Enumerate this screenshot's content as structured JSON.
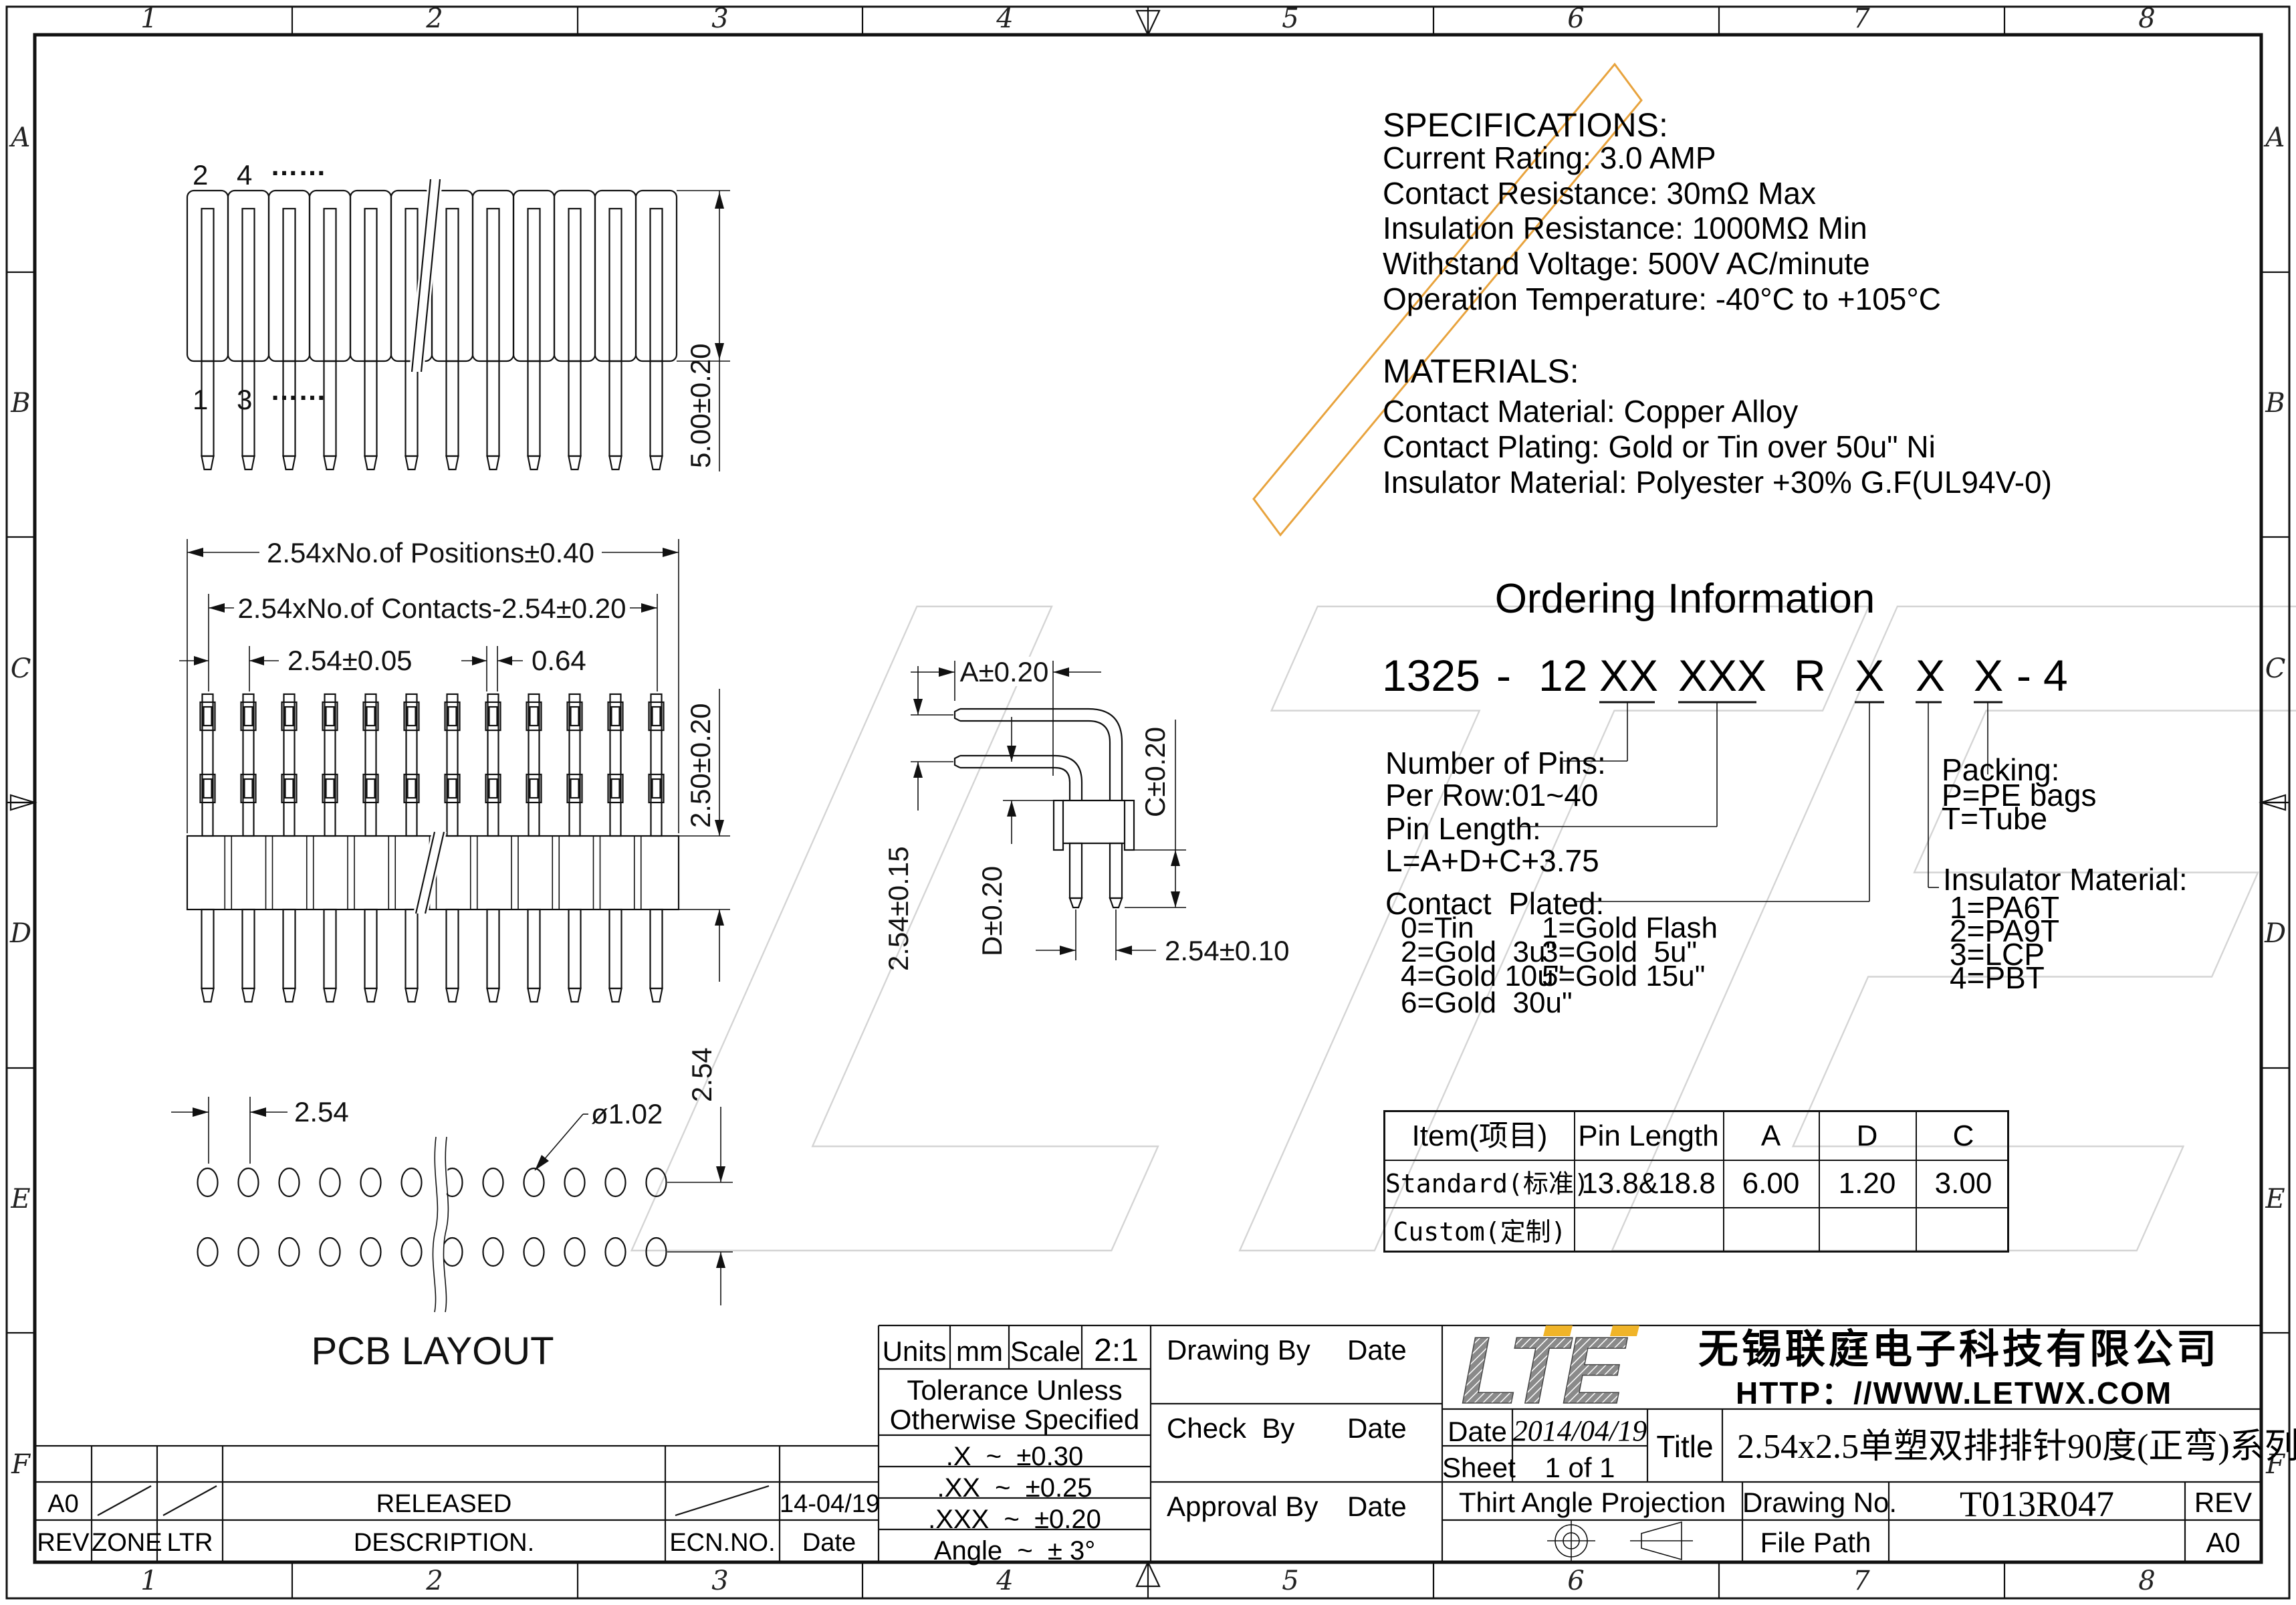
{
  "frame": {
    "zone_columns": [
      "1",
      "2",
      "3",
      "4",
      "5",
      "6",
      "7",
      "8"
    ],
    "zone_rows": [
      "A",
      "B",
      "C",
      "D",
      "E",
      "F"
    ]
  },
  "watermark": {
    "text": "LTE"
  },
  "specifications": {
    "heading": "SPECIFICATIONS:",
    "lines": [
      "Current Rating: 3.0 AMP",
      "Contact Resistance: 30mΩ Max",
      "Insulation Resistance: 1000MΩ Min",
      "Withstand Voltage: 500V AC/minute",
      "Operation Temperature: -40°C to +105°C"
    ]
  },
  "materials": {
    "heading": "MATERIALS:",
    "lines": [
      "Contact Material: Copper Alloy",
      "Contact Plating: Gold or Tin over 50u\" Ni",
      "Insulator Material: Polyester +30% G.F(UL94V-0)"
    ]
  },
  "ordering": {
    "title": "Ordering Information",
    "part_segments": [
      "1325",
      "-",
      "12",
      "XX",
      "XXX",
      "R",
      "X",
      "X",
      "X",
      "-",
      "4"
    ],
    "number_of_pins": [
      "Number of Pins:",
      "Per Row:01~40"
    ],
    "pin_length": [
      "Pin Length:",
      "L=A+D+C+3.75"
    ],
    "contact_plated_heading": "Contact  Plated:",
    "contact_plated": [
      "0=Tin",
      "1=Gold Flash",
      "2=Gold  3u\"",
      "3=Gold  5u\"",
      "4=Gold 10u\"",
      "5=Gold 15u\"",
      "6=Gold  30u\""
    ],
    "packing": [
      "Packing:",
      "P=PE bags",
      "T=Tube"
    ],
    "insulator": [
      "Insulator Material:",
      "1=PA6T",
      "2=PA9T",
      "3=LCP",
      "4=PBT"
    ]
  },
  "spec_table": {
    "headers": [
      "Item(项目)",
      "Pin Length",
      "A",
      "D",
      "C"
    ],
    "rows": [
      [
        "Standard(标准)",
        "13.8&18.8",
        "6.00",
        "1.20",
        "3.00"
      ],
      [
        "Custom(定制)",
        "",
        "",
        "",
        ""
      ]
    ]
  },
  "drawings": {
    "visible_pins": 12,
    "front_view": {
      "top_labels": [
        "2",
        "4",
        "……"
      ],
      "bottom_labels": [
        "1",
        "3",
        "……"
      ],
      "dim_height": "5.00±0.20"
    },
    "top_view": {
      "dim_positions": "2.54xNo.of Positions±0.40",
      "dim_contacts": "2.54xNo.of Contacts-2.54±0.20",
      "dim_pitch": "2.54±0.05",
      "dim_width": "0.64",
      "dim_housing": "2.50±0.20"
    },
    "side_view": {
      "dim_a": "A±0.20",
      "dim_row_pitch": "2.54±0.15",
      "dim_d": "D±0.20",
      "dim_c": "C±0.20",
      "dim_tail_pitch": "2.54±0.10"
    },
    "pcb_layout": {
      "title": "PCB LAYOUT",
      "dim_pitch": "2.54",
      "dim_hole": "ø1.02",
      "dim_row_pitch": "2.54"
    }
  },
  "title_block": {
    "units_label": "Units",
    "units_value": "mm",
    "scale_label": "Scale",
    "scale_value": "2:1",
    "tolerance_line1": "Tolerance Unless",
    "tolerance_line2": "Otherwise Specified",
    "tolerances": [
      ".X  ~  ±0.30",
      ".XX  ~  ±0.25",
      ".XXX  ~  ±0.20",
      "Angle  ~  ± 3°"
    ],
    "signoff": [
      {
        "role": "Drawing By",
        "date_label": "Date"
      },
      {
        "role": "Check  By",
        "date_label": "Date"
      },
      {
        "role": "Approval By",
        "date_label": "Date"
      }
    ],
    "logo": "LTE",
    "company": "无锡联庭电子科技有限公司",
    "website": "HTTP：//WWW.LETWX.COM",
    "date_label": "Date",
    "date_value": "2014/04/19",
    "sheet_label": "Sheet",
    "sheet_value": "1 of 1",
    "title_label": "Title",
    "title_value": "2.54x2.5单塑双排排针90度(正弯)系列",
    "projection_label": "Thirt Angle Projection",
    "drawing_no_label": "Drawing No.",
    "drawing_no_value": "T013R047",
    "rev_label": "REV",
    "file_path_label": "File Path",
    "size_value": "A0"
  },
  "revision_table": {
    "headers": [
      "REV",
      "ZONE",
      "LTR",
      "DESCRIPTION.",
      "ECN.NO.",
      "Date"
    ],
    "row": {
      "rev": "A0",
      "description": "RELEASED",
      "date": "14-04/19"
    }
  }
}
